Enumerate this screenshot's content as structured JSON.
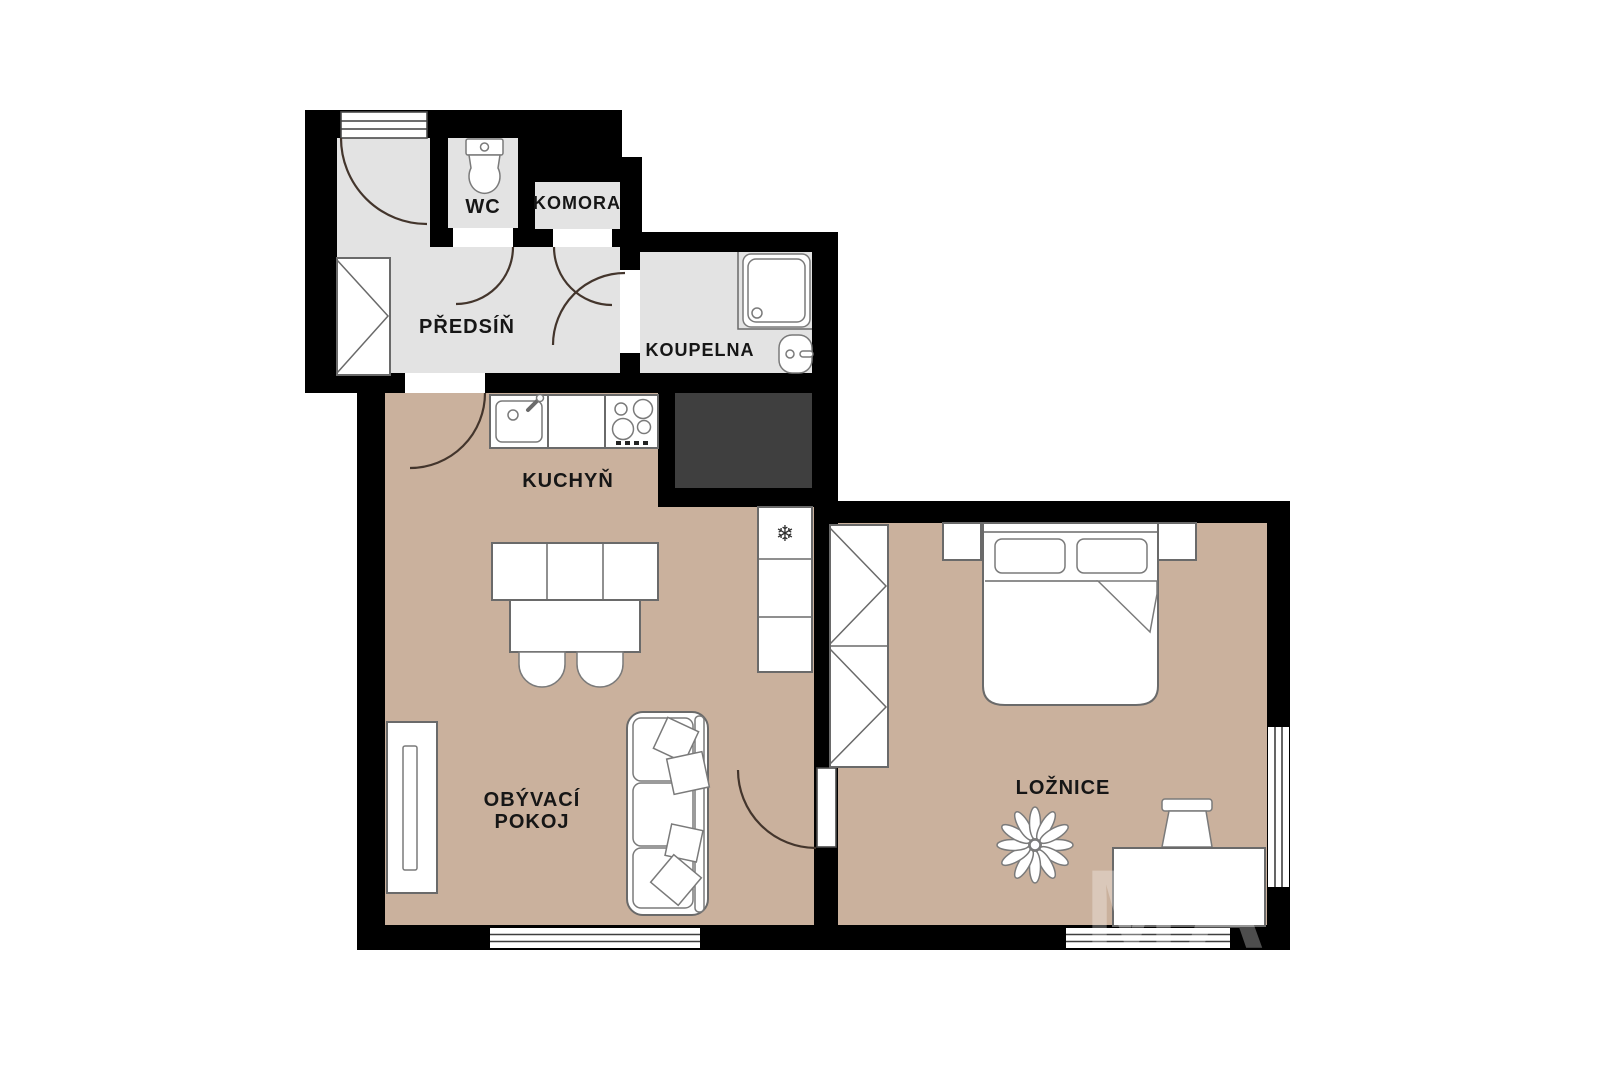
{
  "plan": {
    "type": "apartment-floor-plan",
    "rooms": {
      "hallway": {
        "label": "PŘEDSÍŇ"
      },
      "wc": {
        "label": "WC"
      },
      "pantry": {
        "label": "KOMORA"
      },
      "bathroom": {
        "label": "KOUPELNA"
      },
      "kitchen": {
        "label": "KUCHYŇ"
      },
      "living_room": {
        "label_line1": "OBÝVACÍ",
        "label_line2": "POKOJ"
      },
      "bedroom": {
        "label": "LOŽNICE"
      }
    },
    "icons": {
      "freezer_symbol": "❄"
    },
    "watermark": "MA"
  },
  "colors": {
    "background": "#ffffff",
    "wall": "#000000",
    "floor_warm": "#cab19d",
    "floor_cool": "#e3e3e3",
    "shaft": "#3f3f3f",
    "furniture_fill": "#ffffff",
    "furniture_stroke": "#6a6a6a",
    "label_text": "#161616"
  }
}
